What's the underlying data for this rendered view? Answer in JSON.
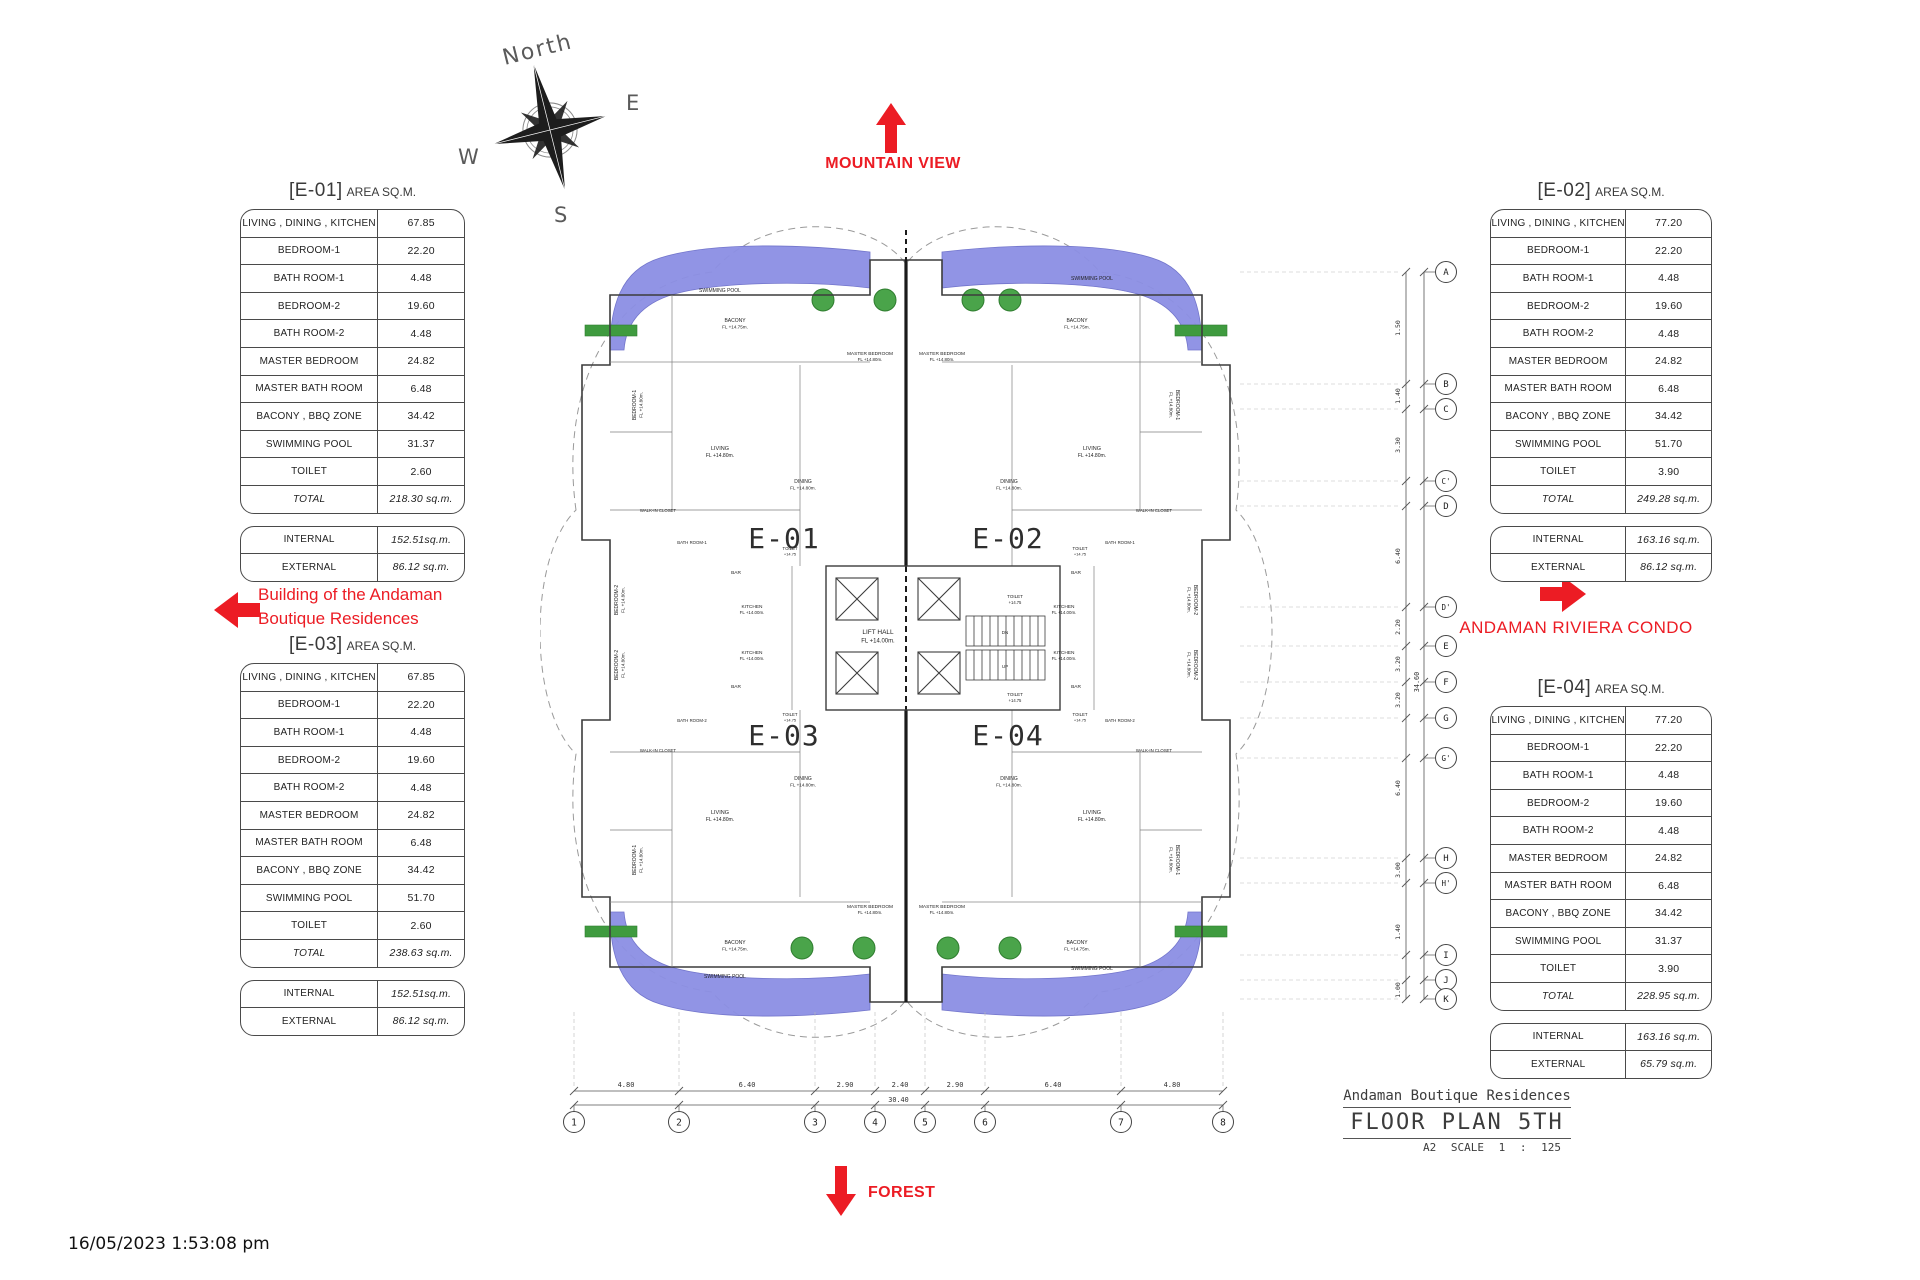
{
  "page": {
    "timestamp": "16/05/2023 1:53:08 pm",
    "red": "#ec1c24",
    "pool_color": "#8c8fe4",
    "green": "#3f9b3f"
  },
  "compass": {
    "north": "North",
    "east": "E",
    "west": "W",
    "south": "S"
  },
  "annotations": {
    "mountain_view": "MOUNTAIN VIEW",
    "forest": "FOREST",
    "building_note_line1": "Building of the Andaman",
    "building_note_line2": "Boutique Residences",
    "riviera_condo": "ANDAMAN RIVIERA CONDO"
  },
  "titleblock": {
    "project": "Andaman Boutique Residences",
    "sheet": "FLOOR PLAN 5TH",
    "scale": "A2 SCALE 1 : 125"
  },
  "tables": [
    {
      "code": "[E-01]",
      "suffix": "AREA SQ.M.",
      "rows": [
        {
          "label": "LIVING , DINING , KITCHEN",
          "value": "67.85"
        },
        {
          "label": "BEDROOM-1",
          "value": "22.20"
        },
        {
          "label": "BATH ROOM-1",
          "value": "4.48"
        },
        {
          "label": "BEDROOM-2",
          "value": "19.60"
        },
        {
          "label": "BATH ROOM-2",
          "value": "4.48"
        },
        {
          "label": "MASTER BEDROOM",
          "value": "24.82"
        },
        {
          "label": "MASTER BATH ROOM",
          "value": "6.48"
        },
        {
          "label": "BACONY , BBQ ZONE",
          "value": "34.42"
        },
        {
          "label": "SWIMMING POOL",
          "value": "31.37"
        },
        {
          "label": "TOILET",
          "value": "2.60"
        },
        {
          "label": "TOTAL",
          "value": "218.30 sq.m.",
          "em": true
        }
      ],
      "extra": [
        {
          "label": "INTERNAL",
          "value": "152.51sq.m.",
          "vi": true
        },
        {
          "label": "EXTERNAL",
          "value": "86.12 sq.m.",
          "vi": true
        }
      ]
    },
    {
      "code": "[E-02]",
      "suffix": "AREA SQ.M.",
      "rows": [
        {
          "label": "LIVING , DINING , KITCHEN",
          "value": "77.20"
        },
        {
          "label": "BEDROOM-1",
          "value": "22.20"
        },
        {
          "label": "BATH ROOM-1",
          "value": "4.48"
        },
        {
          "label": "BEDROOM-2",
          "value": "19.60"
        },
        {
          "label": "BATH ROOM-2",
          "value": "4.48"
        },
        {
          "label": "MASTER BEDROOM",
          "value": "24.82"
        },
        {
          "label": "MASTER BATH ROOM",
          "value": "6.48"
        },
        {
          "label": "BACONY , BBQ ZONE",
          "value": "34.42"
        },
        {
          "label": "SWIMMING POOL",
          "value": "51.70"
        },
        {
          "label": "TOILET",
          "value": "3.90"
        },
        {
          "label": "TOTAL",
          "value": "249.28 sq.m.",
          "em": true
        }
      ],
      "extra": [
        {
          "label": "INTERNAL",
          "value": "163.16 sq.m.",
          "vi": true
        },
        {
          "label": "EXTERNAL",
          "value": "86.12 sq.m.",
          "vi": true
        }
      ]
    },
    {
      "code": "[E-03]",
      "suffix": "AREA SQ.M.",
      "rows": [
        {
          "label": "LIVING , DINING , KITCHEN",
          "value": "67.85"
        },
        {
          "label": "BEDROOM-1",
          "value": "22.20"
        },
        {
          "label": "BATH ROOM-1",
          "value": "4.48"
        },
        {
          "label": "BEDROOM-2",
          "value": "19.60"
        },
        {
          "label": "BATH ROOM-2",
          "value": "4.48"
        },
        {
          "label": "MASTER BEDROOM",
          "value": "24.82"
        },
        {
          "label": "MASTER BATH ROOM",
          "value": "6.48"
        },
        {
          "label": "BACONY , BBQ ZONE",
          "value": "34.42"
        },
        {
          "label": "SWIMMING POOL",
          "value": "51.70"
        },
        {
          "label": "TOILET",
          "value": "2.60"
        },
        {
          "label": "TOTAL",
          "value": "238.63 sq.m.",
          "em": true
        }
      ],
      "extra": [
        {
          "label": "INTERNAL",
          "value": "152.51sq.m.",
          "vi": true
        },
        {
          "label": "EXTERNAL",
          "value": "86.12 sq.m.",
          "vi": true
        }
      ]
    },
    {
      "code": "[E-04]",
      "suffix": "AREA SQ.M.",
      "rows": [
        {
          "label": "LIVING , DINING , KITCHEN",
          "value": "77.20"
        },
        {
          "label": "BEDROOM-1",
          "value": "22.20"
        },
        {
          "label": "BATH ROOM-1",
          "value": "4.48"
        },
        {
          "label": "BEDROOM-2",
          "value": "19.60"
        },
        {
          "label": "BATH ROOM-2",
          "value": "4.48"
        },
        {
          "label": "MASTER BEDROOM",
          "value": "24.82"
        },
        {
          "label": "MASTER BATH ROOM",
          "value": "6.48"
        },
        {
          "label": "BACONY , BBQ ZONE",
          "value": "34.42"
        },
        {
          "label": "SWIMMING POOL",
          "value": "31.37"
        },
        {
          "label": "TOILET",
          "value": "3.90"
        },
        {
          "label": "TOTAL",
          "value": "228.95 sq.m.",
          "em": true
        }
      ],
      "extra": [
        {
          "label": "INTERNAL",
          "value": "163.16 sq.m.",
          "vi": true
        },
        {
          "label": "EXTERNAL",
          "value": "65.79 sq.m.",
          "vi": true
        }
      ]
    }
  ],
  "plan": {
    "units": [
      {
        "t": "E-01",
        "x": 244,
        "y": 348
      },
      {
        "t": "E-02",
        "x": 468,
        "y": 348
      },
      {
        "t": "E-03",
        "x": 244,
        "y": 545
      },
      {
        "t": "E-04",
        "x": 468,
        "y": 545
      }
    ],
    "labels": [
      {
        "t": "SWIMMING POOL",
        "x": 180,
        "y": 92,
        "fs": 5
      },
      {
        "t": "SWIMMING POOL",
        "x": 552,
        "y": 80,
        "fs": 5
      },
      {
        "t": "SWIMMING POOL",
        "x": 185,
        "y": 778,
        "fs": 5
      },
      {
        "t": "SWIMMING POOL",
        "x": 552,
        "y": 770,
        "fs": 5
      },
      {
        "t": "LIFT HALL",
        "s": "FL +14.00m.",
        "x": 338,
        "y": 434,
        "fs": 6.5
      },
      {
        "t": "TOILET",
        "s": "+14.75",
        "x": 475,
        "y": 398,
        "fs": 4.5
      },
      {
        "t": "TOILET",
        "s": "+14.75",
        "x": 475,
        "y": 496,
        "fs": 4.5
      },
      {
        "t": "DN",
        "x": 465,
        "y": 434,
        "fs": 4.5
      },
      {
        "t": "UP",
        "x": 465,
        "y": 468,
        "fs": 4.5
      },
      {
        "t": "BEDROOM-1",
        "s": "FL +14.80m.",
        "x": 96,
        "y": 205,
        "r": -90,
        "fs": 5
      },
      {
        "t": "BACONY",
        "s": "FL +14.75m.",
        "x": 195,
        "y": 122,
        "fs": 5
      },
      {
        "t": "MASTER BEDROOM",
        "s": "FL +14.80m.",
        "x": 330,
        "y": 155,
        "fs": 4.8
      },
      {
        "t": "LIVING",
        "s": "FL +14.80m.",
        "x": 180,
        "y": 250,
        "fs": 5.5
      },
      {
        "t": "DINING",
        "s": "FL +14.80m.",
        "x": 263,
        "y": 283,
        "fs": 5
      },
      {
        "t": "WALK-IN CLOSET",
        "x": 118,
        "y": 312,
        "fs": 4.3
      },
      {
        "t": "BATH ROOM-1",
        "x": 152,
        "y": 344,
        "fs": 4.3
      },
      {
        "t": "BEDROOM-2",
        "s": "FL +14.80m.",
        "x": 78,
        "y": 400,
        "r": -90,
        "fs": 5
      },
      {
        "t": "BAR",
        "x": 196,
        "y": 374,
        "fs": 4.8
      },
      {
        "t": "KITCHEN",
        "s": "FL +14.00m.",
        "x": 212,
        "y": 408,
        "fs": 4.8
      },
      {
        "t": "TOILET",
        "s": "+14.75",
        "x": 250,
        "y": 350,
        "fs": 4.3
      },
      {
        "t": "BEDROOM-1",
        "s": "FL +14.80m.",
        "x": 636,
        "y": 205,
        "r": 90,
        "fs": 5
      },
      {
        "t": "BACONY",
        "s": "FL +14.75m.",
        "x": 537,
        "y": 122,
        "fs": 5
      },
      {
        "t": "MASTER BEDROOM",
        "s": "FL +14.80m.",
        "x": 402,
        "y": 155,
        "fs": 4.8
      },
      {
        "t": "LIVING",
        "s": "FL +14.80m.",
        "x": 552,
        "y": 250,
        "fs": 5.5
      },
      {
        "t": "DINING",
        "s": "FL +14.80m.",
        "x": 469,
        "y": 283,
        "fs": 5
      },
      {
        "t": "WALK-IN CLOSET",
        "x": 614,
        "y": 312,
        "fs": 4.3
      },
      {
        "t": "BATH ROOM-1",
        "x": 580,
        "y": 344,
        "fs": 4.3
      },
      {
        "t": "BEDROOM-2",
        "s": "FL +14.80m.",
        "x": 654,
        "y": 400,
        "r": 90,
        "fs": 5
      },
      {
        "t": "BAR",
        "x": 536,
        "y": 374,
        "fs": 4.8
      },
      {
        "t": "KITCHEN",
        "s": "FL +14.00m.",
        "x": 524,
        "y": 408,
        "fs": 4.8
      },
      {
        "t": "TOILET",
        "s": "+14.75",
        "x": 540,
        "y": 350,
        "fs": 4.3
      },
      {
        "t": "BEDROOM-1",
        "s": "FL +14.80m.",
        "x": 96,
        "y": 660,
        "r": -90,
        "fs": 5
      },
      {
        "t": "BACONY",
        "s": "FL +14.75m.",
        "x": 195,
        "y": 744,
        "fs": 5
      },
      {
        "t": "MASTER BEDROOM",
        "s": "FL +14.80m.",
        "x": 330,
        "y": 708,
        "fs": 4.8
      },
      {
        "t": "LIVING",
        "s": "FL +14.80m.",
        "x": 180,
        "y": 614,
        "fs": 5.5
      },
      {
        "t": "DINING",
        "s": "FL +14.80m.",
        "x": 263,
        "y": 580,
        "fs": 5
      },
      {
        "t": "WALK-IN CLOSET",
        "x": 118,
        "y": 552,
        "fs": 4.3
      },
      {
        "t": "BATH ROOM-2",
        "x": 152,
        "y": 522,
        "fs": 4.3
      },
      {
        "t": "BEDROOM-2",
        "s": "FL +14.80m.",
        "x": 78,
        "y": 465,
        "r": -90,
        "fs": 5
      },
      {
        "t": "BAR",
        "x": 196,
        "y": 488,
        "fs": 4.8
      },
      {
        "t": "KITCHEN",
        "s": "FL +14.00m.",
        "x": 212,
        "y": 454,
        "fs": 4.8
      },
      {
        "t": "TOILET",
        "s": "+14.75",
        "x": 250,
        "y": 516,
        "fs": 4.3
      },
      {
        "t": "BEDROOM-1",
        "s": "FL +14.80m.",
        "x": 636,
        "y": 660,
        "r": 90,
        "fs": 5
      },
      {
        "t": "BACONY",
        "s": "FL +14.75m.",
        "x": 537,
        "y": 744,
        "fs": 5
      },
      {
        "t": "MASTER BEDROOM",
        "s": "FL +14.80m.",
        "x": 402,
        "y": 708,
        "fs": 4.8
      },
      {
        "t": "LIVING",
        "s": "FL +14.80m.",
        "x": 552,
        "y": 614,
        "fs": 5.5
      },
      {
        "t": "DINING",
        "s": "FL +14.80m.",
        "x": 469,
        "y": 580,
        "fs": 5
      },
      {
        "t": "WALK-IN CLOSET",
        "x": 614,
        "y": 552,
        "fs": 4.3
      },
      {
        "t": "BATH ROOM-2",
        "x": 580,
        "y": 522,
        "fs": 4.3
      },
      {
        "t": "BEDROOM-2",
        "s": "FL +14.80m.",
        "x": 654,
        "y": 465,
        "r": 90,
        "fs": 5
      },
      {
        "t": "BAR",
        "x": 536,
        "y": 488,
        "fs": 4.8
      },
      {
        "t": "KITCHEN",
        "s": "FL +14.00m.",
        "x": 524,
        "y": 454,
        "fs": 4.8
      },
      {
        "t": "TOILET",
        "s": "+14.75",
        "x": 540,
        "y": 516,
        "fs": 4.3
      }
    ]
  },
  "grid": {
    "bottom": {
      "total": "30.40",
      "bubbles": [
        {
          "n": "1",
          "x": 34
        },
        {
          "n": "2",
          "x": 139
        },
        {
          "n": "3",
          "x": 275
        },
        {
          "n": "4",
          "x": 335
        },
        {
          "n": "5",
          "x": 385
        },
        {
          "n": "6",
          "x": 445
        },
        {
          "n": "7",
          "x": 581
        },
        {
          "n": "8",
          "x": 683
        }
      ],
      "dims": [
        {
          "t": "4.80",
          "x": 86
        },
        {
          "t": "6.40",
          "x": 207
        },
        {
          "t": "2.90",
          "x": 305
        },
        {
          "t": "2.40",
          "x": 360
        },
        {
          "t": "2.90",
          "x": 415
        },
        {
          "t": "6.40",
          "x": 513
        },
        {
          "t": "4.80",
          "x": 632
        }
      ]
    },
    "right": {
      "total": "34.60",
      "bubbles": [
        {
          "n": "A",
          "y": 72
        },
        {
          "n": "B",
          "y": 184
        },
        {
          "n": "C",
          "y": 209
        },
        {
          "n": "C'",
          "y": 281
        },
        {
          "n": "D",
          "y": 306
        },
        {
          "n": "D'",
          "y": 407
        },
        {
          "n": "E",
          "y": 446
        },
        {
          "n": "F",
          "y": 482
        },
        {
          "n": "G",
          "y": 518
        },
        {
          "n": "G'",
          "y": 558
        },
        {
          "n": "H",
          "y": 658
        },
        {
          "n": "H'",
          "y": 683
        },
        {
          "n": "I",
          "y": 755
        },
        {
          "n": "J",
          "y": 780
        },
        {
          "n": "K",
          "y": 799
        }
      ],
      "dims": [
        {
          "t": "1.50",
          "y": 128
        },
        {
          "t": "1.40",
          "y": 196
        },
        {
          "t": "3.30",
          "y": 245
        },
        {
          "t": "6.40",
          "y": 356
        },
        {
          "t": "2.20",
          "y": 427
        },
        {
          "t": "3.20",
          "y": 464
        },
        {
          "t": "3.20",
          "y": 500
        },
        {
          "t": "6.40",
          "y": 588
        },
        {
          "t": "3.00",
          "y": 670
        },
        {
          "t": "1.40",
          "y": 732
        },
        {
          "t": "1.00",
          "y": 790
        }
      ]
    }
  }
}
